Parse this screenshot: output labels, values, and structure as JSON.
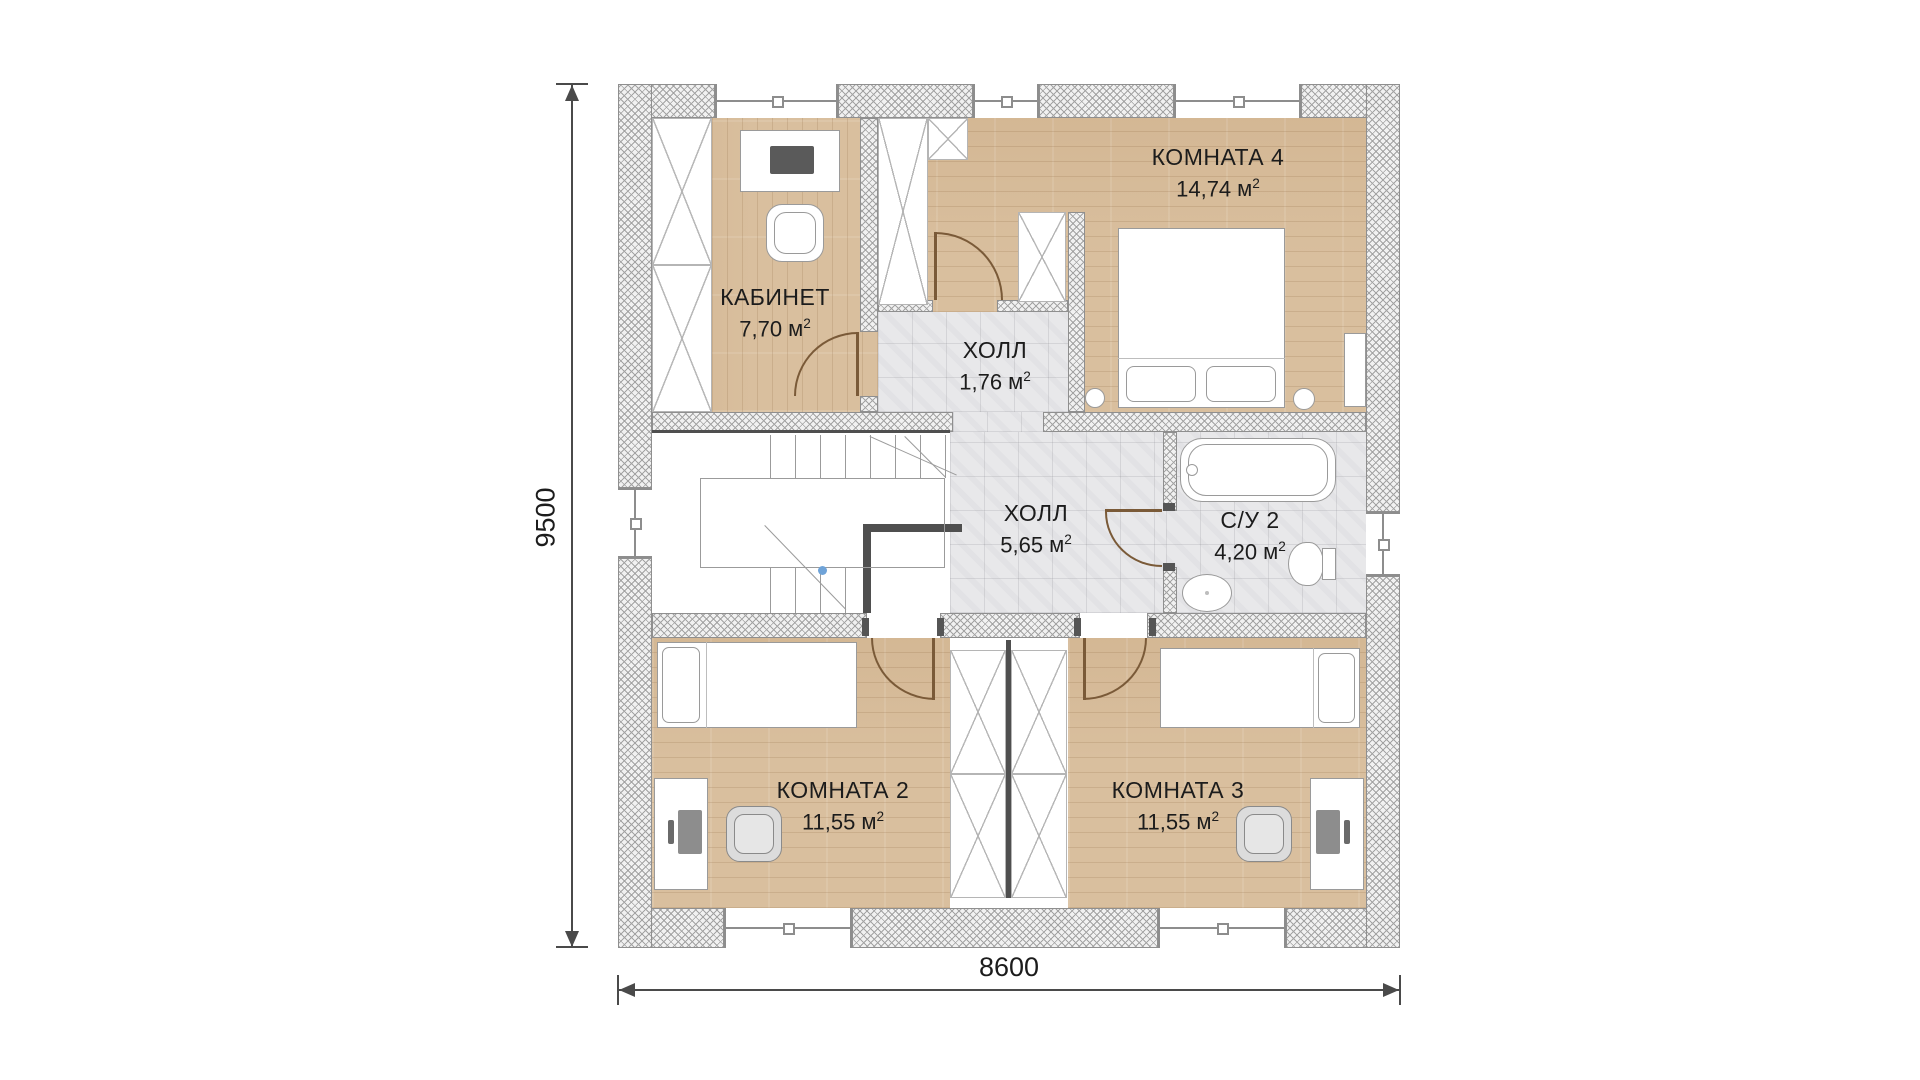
{
  "plan": {
    "title": "floor-plan-second-level",
    "rooms": [
      {
        "key": "kabinet",
        "name": "КАБИНЕТ",
        "area": "7,70",
        "unit": "м",
        "sup": "2"
      },
      {
        "key": "hall-small",
        "name": "ХОЛЛ",
        "area": "1,76",
        "unit": "м",
        "sup": "2"
      },
      {
        "key": "room4",
        "name": "КОМНАТА 4",
        "area": "14,74",
        "unit": "м",
        "sup": "2"
      },
      {
        "key": "hall-main",
        "name": "ХОЛЛ",
        "area": "5,65",
        "unit": "м",
        "sup": "2"
      },
      {
        "key": "su2",
        "name": "С/У 2",
        "area": "4,20",
        "unit": "м",
        "sup": "2"
      },
      {
        "key": "room2",
        "name": "КОМНАТА 2",
        "area": "11,55",
        "unit": "м",
        "sup": "2"
      },
      {
        "key": "room3",
        "name": "КОМНАТА 3",
        "area": "11,55",
        "unit": "м",
        "sup": "2"
      }
    ],
    "dimensions": {
      "height_label": "9500",
      "width_label": "8600"
    },
    "colors": {
      "wood": "#d9bf9e",
      "tile": "#e8e8ea",
      "wall_hatch_line": "#a3a3a3",
      "accent_wall": "#4f4f4f",
      "door": "#7a5a38",
      "stair_marker": "#6fa3d8"
    }
  }
}
